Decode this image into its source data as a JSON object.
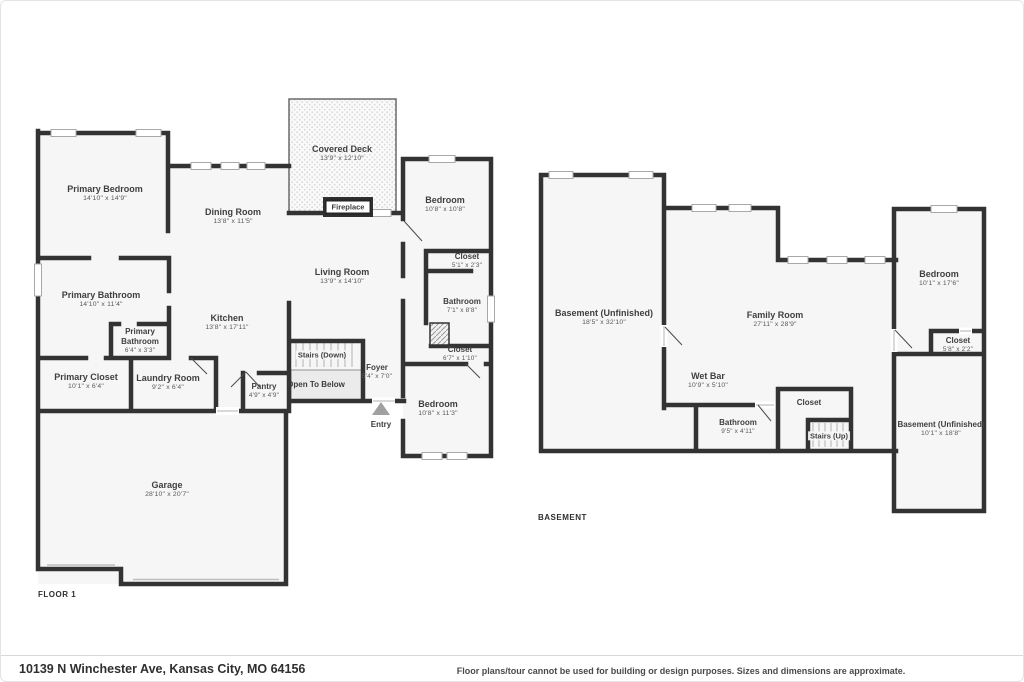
{
  "meta": {
    "colors": {
      "wall": "#333333",
      "floor_fill": "#f6f6f6",
      "deck_dot": "#d9d9d9"
    }
  },
  "floor1": {
    "label": "FLOOR 1",
    "rooms": {
      "primary_bedroom": {
        "name": "Primary Bedroom",
        "dims": "14'10\" x 14'9\""
      },
      "dining_room": {
        "name": "Dining Room",
        "dims": "13'8\" x 11'5\""
      },
      "covered_deck": {
        "name": "Covered Deck",
        "dims": "13'9\" x 12'10\""
      },
      "fireplace": {
        "name": "Fireplace"
      },
      "bedroom_top": {
        "name": "Bedroom",
        "dims": "10'8\" x 10'8\""
      },
      "living_room": {
        "name": "Living Room",
        "dims": "13'9\" x 14'10\""
      },
      "primary_bathroom": {
        "name": "Primary Bathroom",
        "dims": "14'10\" x 11'4\""
      },
      "kitchen": {
        "name": "Kitchen",
        "dims": "13'8\" x 17'11\""
      },
      "primary_bathroom_sm": {
        "name": "Primary Bathroom",
        "dims": "6'4\" x 3'3\""
      },
      "closet_top": {
        "name": "Closet",
        "dims": "5'1\" x 2'3\""
      },
      "bathroom": {
        "name": "Bathroom",
        "dims": "7'1\" x 8'8\""
      },
      "primary_closet": {
        "name": "Primary Closet",
        "dims": "10'1\" x 6'4\""
      },
      "laundry_room": {
        "name": "Laundry Room",
        "dims": "9'2\" x 6'4\""
      },
      "pantry": {
        "name": "Pantry",
        "dims": "4'9\" x 4'9\""
      },
      "stairs_down": {
        "name": "Stairs (Down)"
      },
      "open_to_below": {
        "name": "Open To Below"
      },
      "foyer": {
        "name": "Foyer",
        "dims": "5'4\" x 7'0\""
      },
      "closet_mid": {
        "name": "Closet",
        "dims": "6'7\" x 1'10\""
      },
      "bedroom_bottom": {
        "name": "Bedroom",
        "dims": "10'8\" x 11'3\""
      },
      "entry": {
        "name": "Entry"
      },
      "garage": {
        "name": "Garage",
        "dims": "28'10\" x 20'7\""
      }
    }
  },
  "basement": {
    "label": "BASEMENT",
    "rooms": {
      "basement_left": {
        "name": "Basement (Unfinished)",
        "dims": "18'5\" x 32'10\""
      },
      "family_room": {
        "name": "Family Room",
        "dims": "27'11\" x 28'9\""
      },
      "bedroom": {
        "name": "Bedroom",
        "dims": "10'1\" x 17'6\""
      },
      "closet_right": {
        "name": "Closet",
        "dims": "5'8\" x 2'2\""
      },
      "wet_bar": {
        "name": "Wet Bar",
        "dims": "10'9\" x 5'10\""
      },
      "closet_small": {
        "name": "Closet"
      },
      "bathroom": {
        "name": "Bathroom",
        "dims": "9'5\" x 4'11\""
      },
      "stairs_up": {
        "name": "Stairs (Up)"
      },
      "basement_right": {
        "name": "Basement (Unfinished)",
        "dims": "10'1\" x 18'8\""
      }
    }
  },
  "footer": {
    "address": "10139 N Winchester Ave, Kansas City, MO 64156",
    "disclaimer": "Floor plans/tour cannot be used for building or design purposes. Sizes and dimensions are approximate."
  }
}
